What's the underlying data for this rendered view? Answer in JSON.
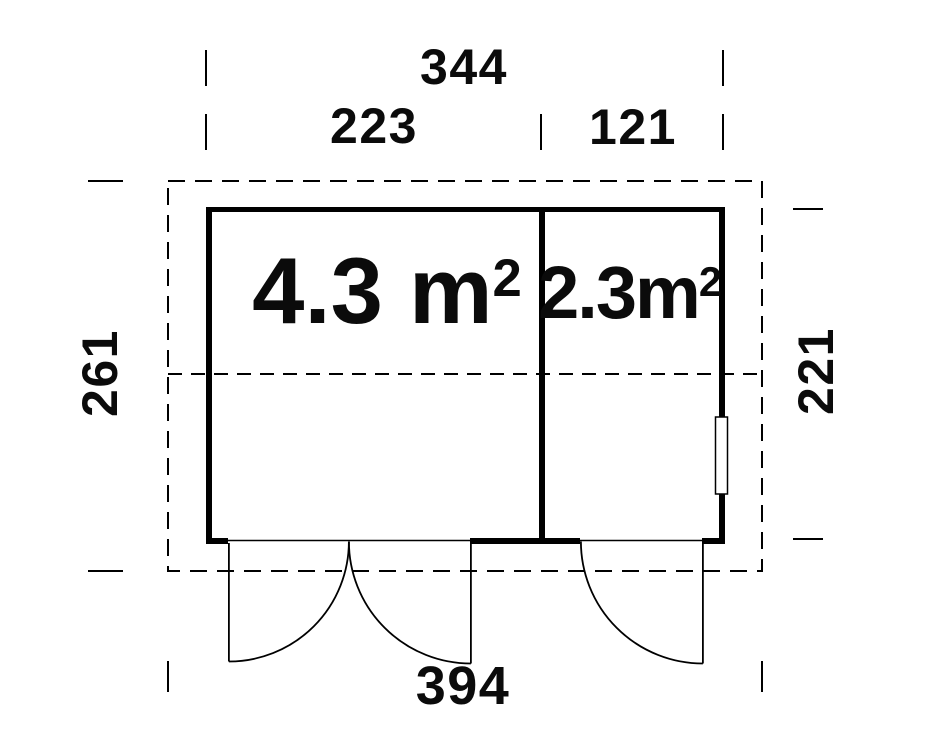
{
  "plan": {
    "dim_top_overall": "344",
    "dim_top_left_room": "223",
    "dim_top_right_room": "121",
    "dim_left_height": "261",
    "dim_right_height": "221",
    "dim_bottom_overall": "394",
    "room_left": {
      "area": "4.3 m",
      "area_sup": "2"
    },
    "room_right": {
      "area": "2.3m",
      "area_sup": "2"
    },
    "colors": {
      "line": "#000000",
      "background": "#ffffff"
    }
  }
}
